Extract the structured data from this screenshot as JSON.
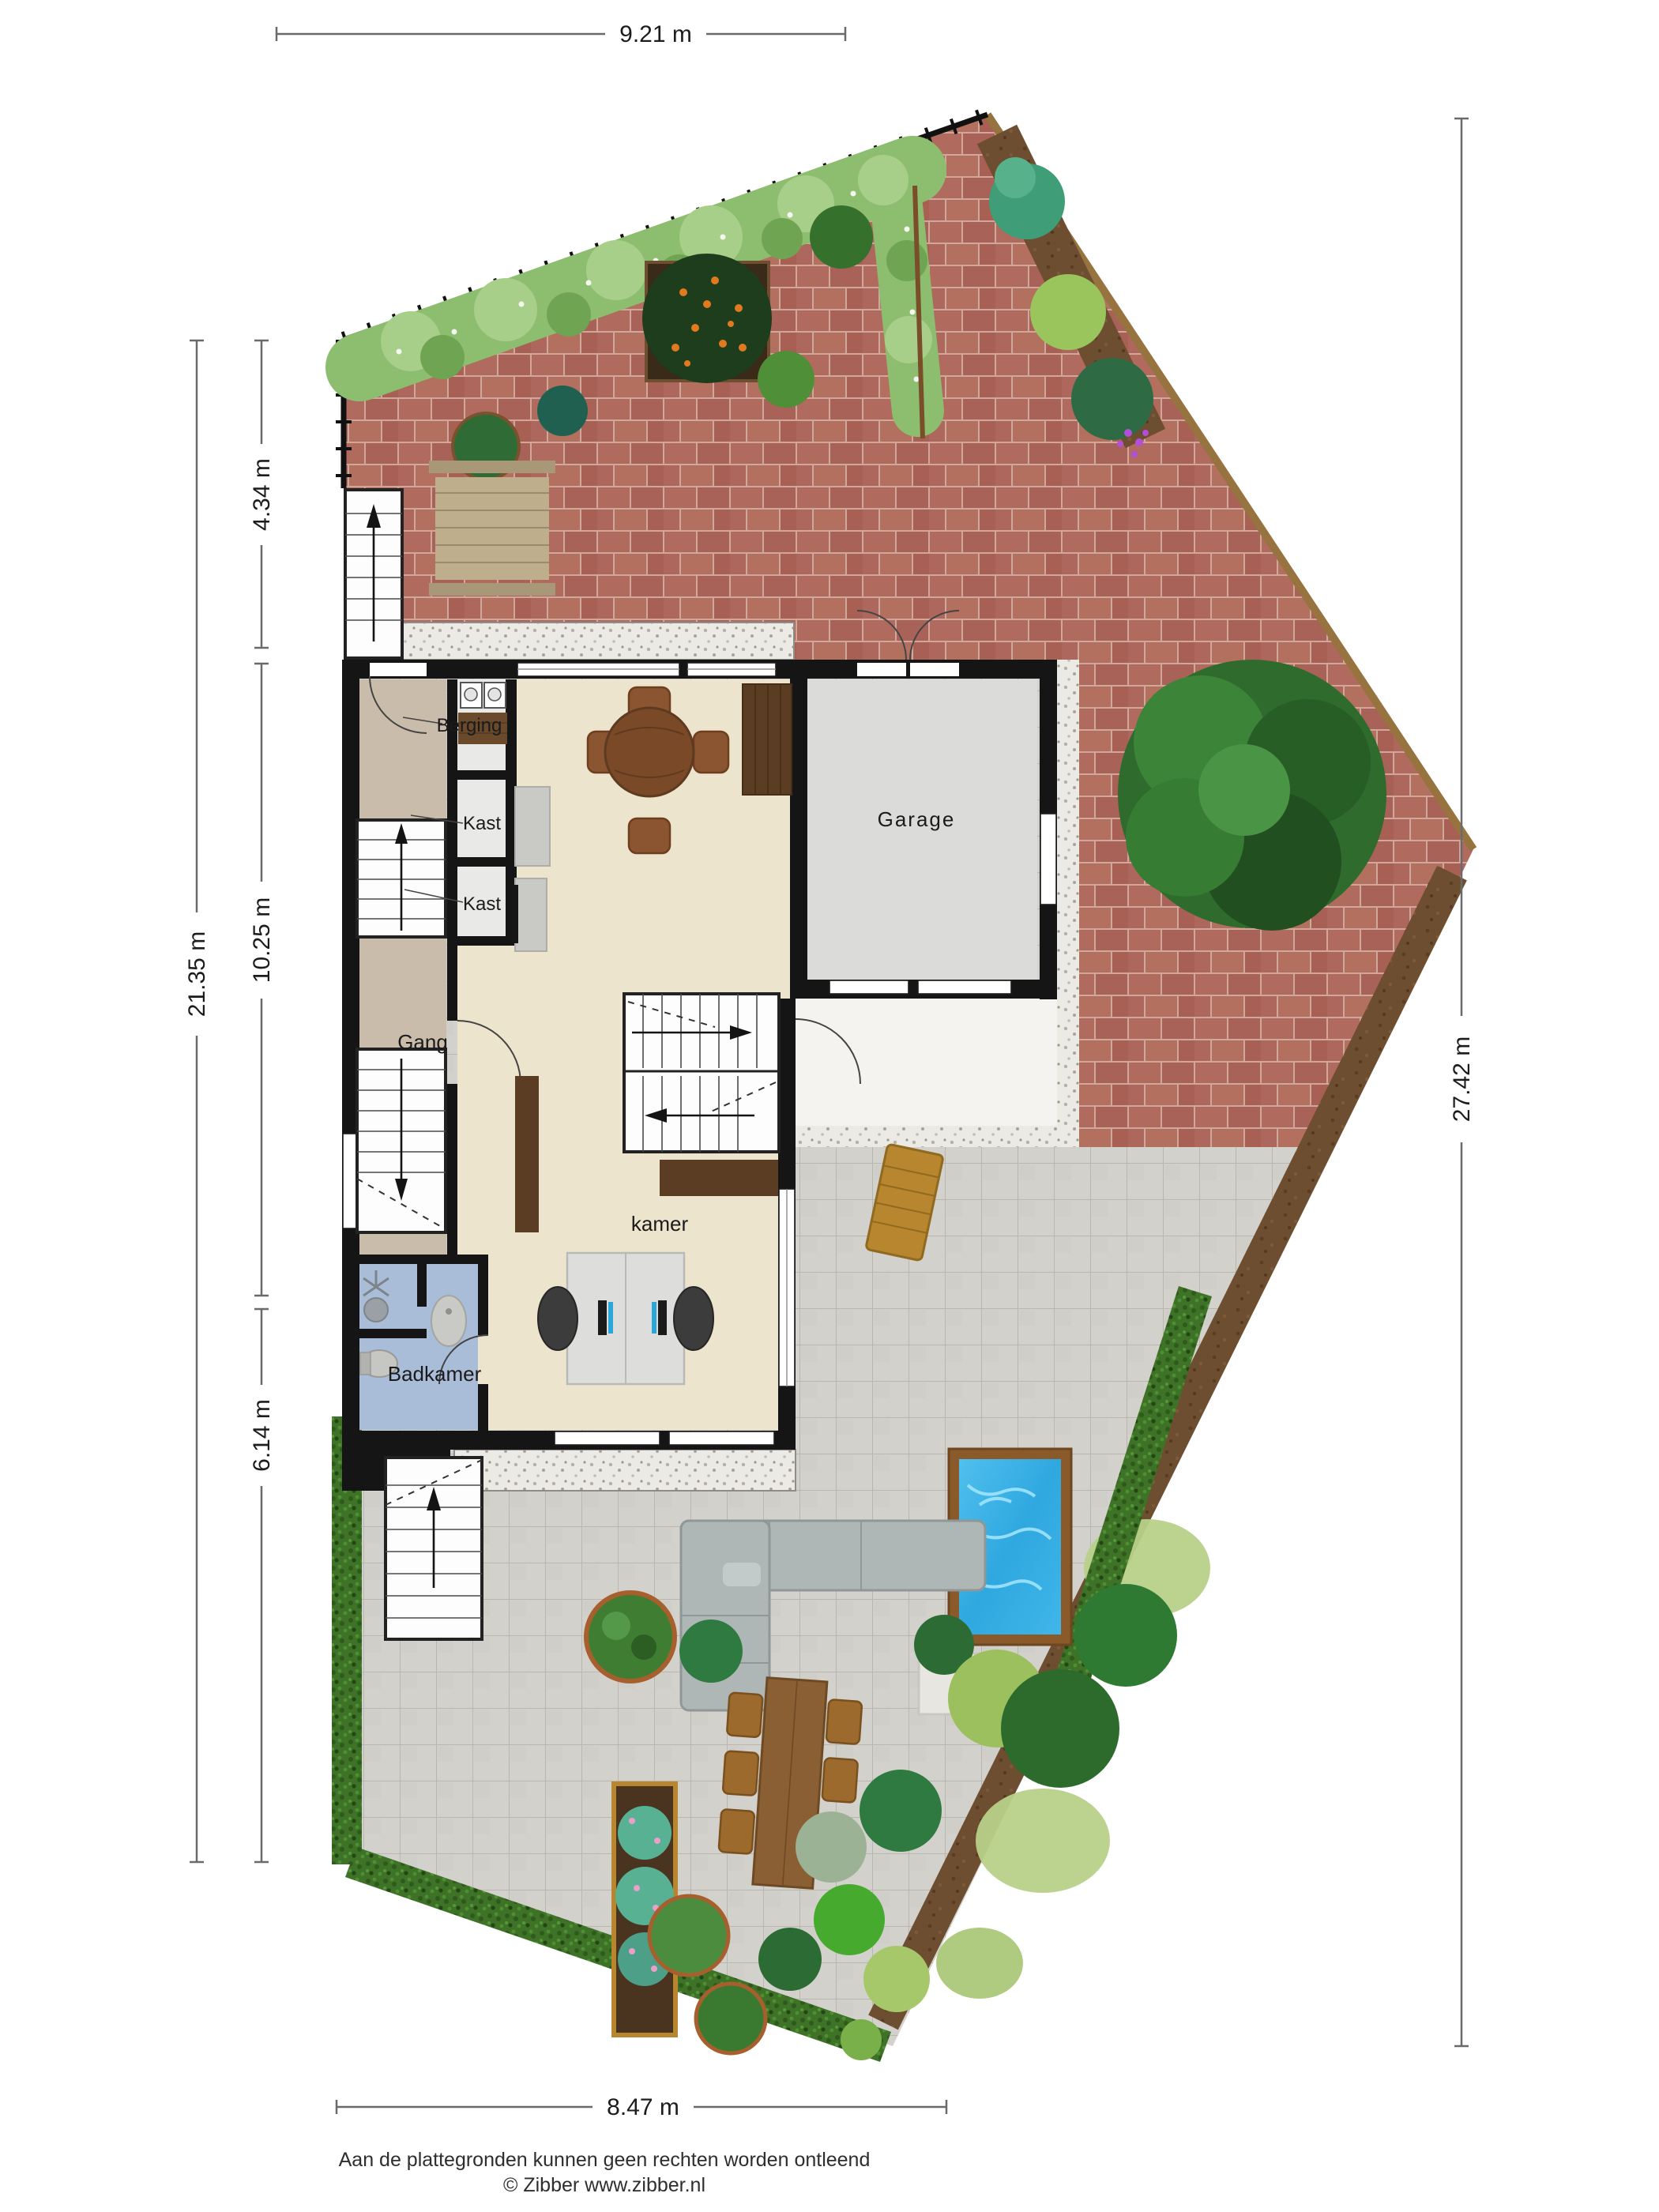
{
  "dimensions": {
    "top": "9.21 m",
    "left_total": "21.35 m",
    "left_top": "4.34 m",
    "left_middle": "10.25 m",
    "left_bottom": "6.14 m",
    "right": "27.42 m",
    "bottom": "8.47 m"
  },
  "rooms": {
    "berging": "Berging",
    "kast_1": "Kast",
    "kast_2": "Kast",
    "gang": "Gang",
    "garage": "Garage",
    "kamer": "kamer",
    "badkamer": "Badkamer"
  },
  "footer": {
    "disclaimer": "Aan de plattegronden kunnen geen rechten worden ontleend",
    "credit": "© Zibber www.zibber.nl"
  },
  "colors": {
    "pool_water": "#2fa8e0",
    "floor_beige": "#ece4cc",
    "floor_taupe": "#c9bcab",
    "floor_blue": "#a9bdd8",
    "garage_floor": "#dbdbd9"
  }
}
